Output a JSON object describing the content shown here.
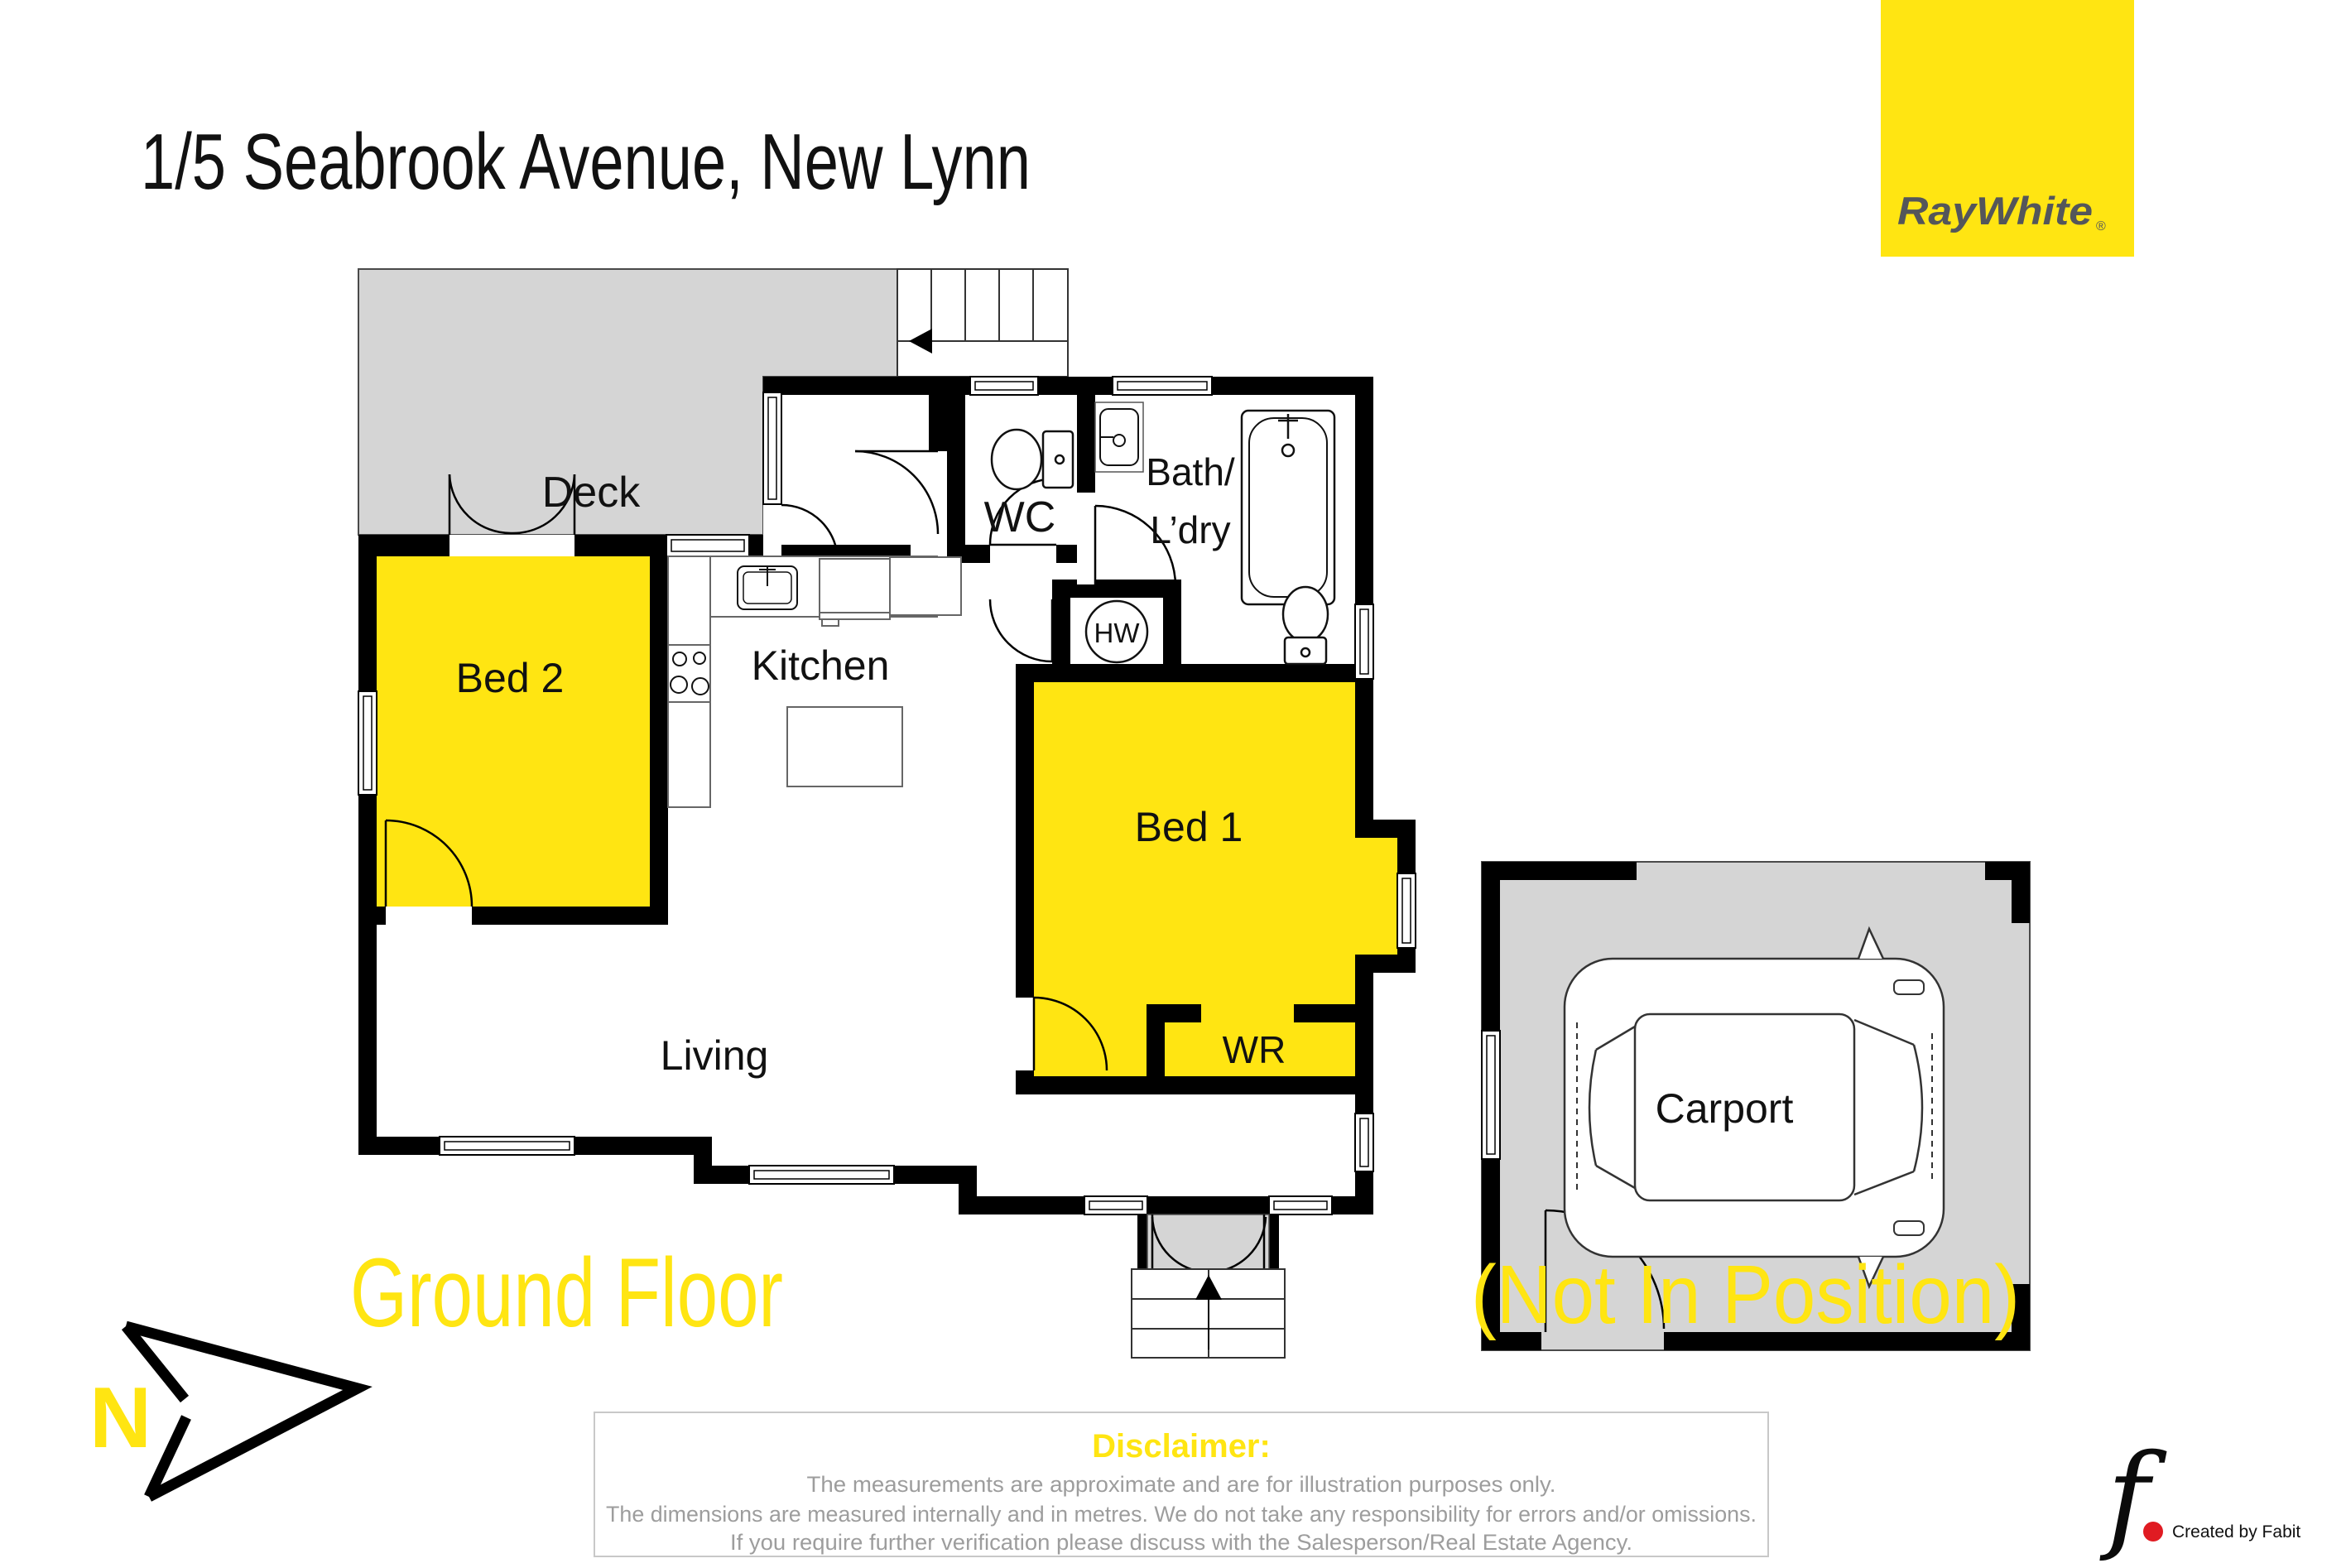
{
  "title": "1/5 Seabrook Avenue, New Lynn",
  "brand": {
    "name": "RayWhite",
    "registered": "®"
  },
  "plan": {
    "floor_label": "Ground Floor",
    "carport_note": "(Not In Position)",
    "compass_n": "N",
    "rooms": {
      "deck": "Deck",
      "bed2": "Bed 2",
      "kitchen": "Kitchen",
      "living": "Living",
      "wc": "WC",
      "bath_line1": "Bath/",
      "bath_line2": "L’dry",
      "hw": "HW",
      "bed1": "Bed 1",
      "wr": "WR",
      "carport": "Carport"
    }
  },
  "disclaimer": {
    "title": "Disclaimer:",
    "lines": [
      "The measurements are approximate and are for illustration purposes only.",
      "The dimensions are measured internally and in metres. We do not take any responsibility for errors and/or omissions.",
      "If you require further verification please discuss with the Salesperson/Real Estate Agency."
    ]
  },
  "credit": {
    "glyph": "f",
    "text": "Created by Fabit"
  },
  "colors": {
    "brand_yellow": "#FFE512",
    "brand_gray": "#54565A",
    "deck_gray": "#D5D5D5",
    "wall_black": "#000000",
    "disclaimer_gray": "#9D9D9D",
    "credit_red": "#E01B22"
  }
}
